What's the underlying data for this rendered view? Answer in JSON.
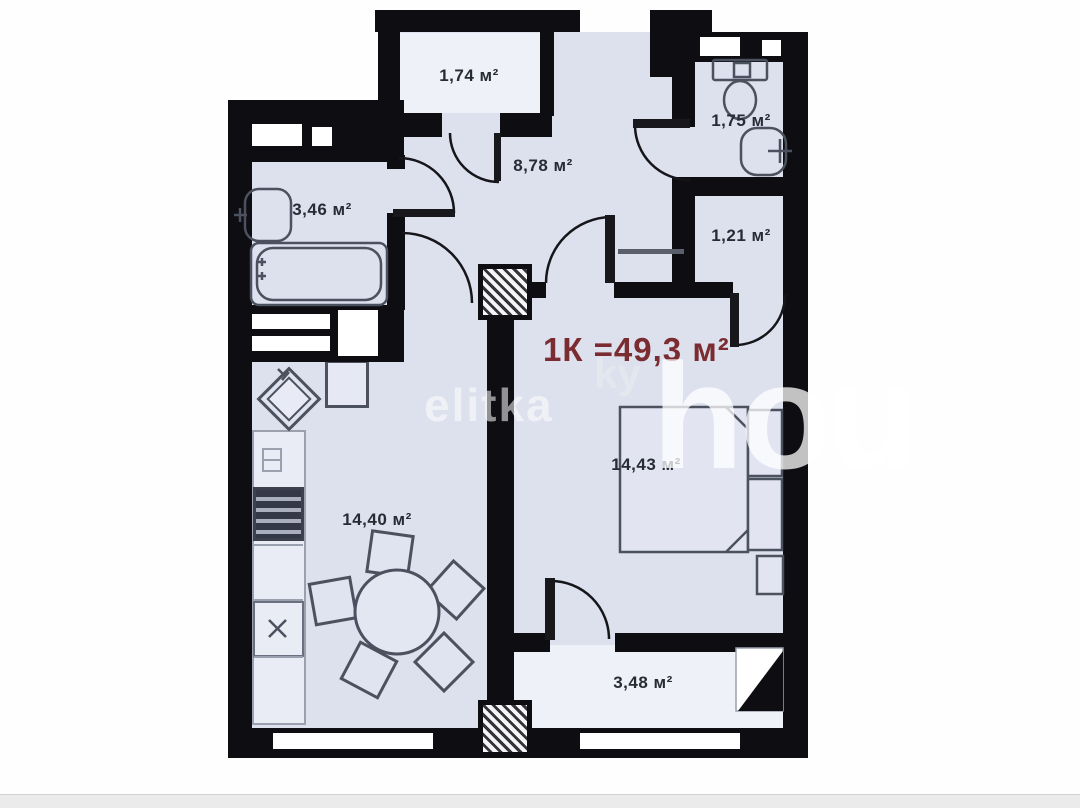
{
  "plan": {
    "title": "1К =49,3 м²",
    "title_color": "#7b2c31",
    "watermark": {
      "small": "elitka",
      "small2": "ky",
      "large": "hou"
    },
    "rooms": [
      {
        "id": "balcony-top",
        "label": "1,74 м²"
      },
      {
        "id": "hallway",
        "label": "8,78 м²"
      },
      {
        "id": "wc",
        "label": "1,75 м²"
      },
      {
        "id": "storage",
        "label": "1,21 м²"
      },
      {
        "id": "bathroom",
        "label": "3,46 м²"
      },
      {
        "id": "bedroom",
        "label": "14,43 м²"
      },
      {
        "id": "kitchen-living",
        "label": "14,40 м²"
      },
      {
        "id": "balcony-bottom",
        "label": "3,48 м²"
      }
    ]
  }
}
